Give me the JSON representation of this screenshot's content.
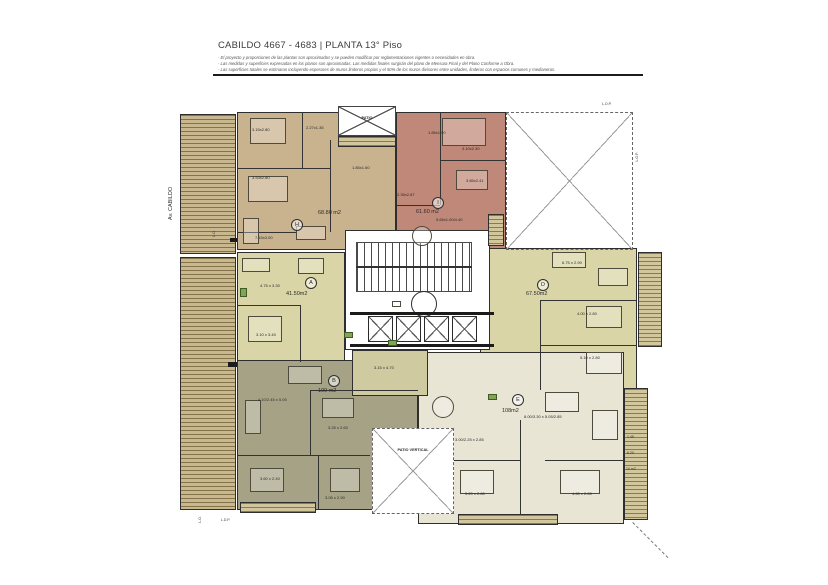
{
  "header": {
    "title": "CABILDO 4667 - 4683 | PLANTA 13° Piso",
    "notes": [
      "- El proyecto y proporciones de las plantas son aproximados y se pueden modificar por reglamentaciones vigentes o necesidades en obra.",
      "- Las medidas y superficies expresadas en los planos son aproximadas. Las medidas finales surgirán del plano de Mensura Final y del Plano Conforme a Obra.",
      "- Las superficies totales se estimaron incluyendo espesores de muros linderos propios y el 50% de los muros divisores entre unidades, linderos con espacios comunes y medianeras."
    ]
  },
  "streets": {
    "left_top": "Av. CABILDO",
    "left_bottom": "Av. CABILDO"
  },
  "boundaries": {
    "lo_left_top": "L.O.",
    "lo_left_bottom": "L.O.",
    "ldp_bottom": "L.D.P.",
    "lop_top": "L.O.P.",
    "lop_right": "L.O.P."
  },
  "patios": {
    "top": "PATIO",
    "bottom": "PATIO VERTICAL"
  },
  "units": {
    "H": {
      "letter": "H",
      "area": "68.80 m2",
      "rooms": {
        "r1": "3.15x2.80",
        "r2": "2.27x1.35",
        "r3": "3.53x2.80",
        "r4": "1.85x1.60",
        "r5": "7.15x3.00"
      }
    },
    "I": {
      "letter": "I",
      "area": "61.60 m2",
      "rooms": {
        "r1": "1.85x1.90",
        "r2": "3.10x2.30",
        "r3": "3.85x2.41",
        "r4": "2.35x2.87",
        "r5": "5.65x1.00/4.40"
      }
    },
    "A": {
      "letter": "A",
      "area": "41.50m2",
      "rooms": {
        "r1": "4.75 x 3.30",
        "r2": "3.10 x 3.40"
      }
    },
    "D": {
      "letter": "D",
      "area": "67.50m2",
      "rooms": {
        "r1": "6.75 x 2.90",
        "r2": "4.00 x 2.80",
        "r3": "5.10 x 2.80"
      }
    },
    "B": {
      "letter": "B",
      "area": "100 m2",
      "rooms": {
        "r1": "4.10/2.45 x 5.05",
        "r2": "3.25 x 2.60",
        "r3": "3.15 x 4.70",
        "r4": "3.60 x 2.40",
        "r5": "3.05 x 2.90"
      }
    },
    "E": {
      "letter": "E",
      "area": "108m2",
      "rooms": {
        "r1": "8.00/3.30 x 5.05/2.85",
        "r2": "3.00/2.25 x 2.85",
        "r3": "3.20 x 2.80",
        "r4": "4.65 x 2.80"
      }
    }
  },
  "balcony_dims": {
    "d1": "1.45",
    "d2": "6.20",
    "d3": "10 m2"
  },
  "colors": {
    "unit_h": "#c9b28e",
    "unit_i": "#bf8878",
    "unit_a": "#d9d5a6",
    "unit_d": "#d9d5a6",
    "unit_b": "#a6a286",
    "unit_e": "#e8e5d4",
    "balcony_hatch": "#c9b88f",
    "walls": "#2e2e2e"
  }
}
